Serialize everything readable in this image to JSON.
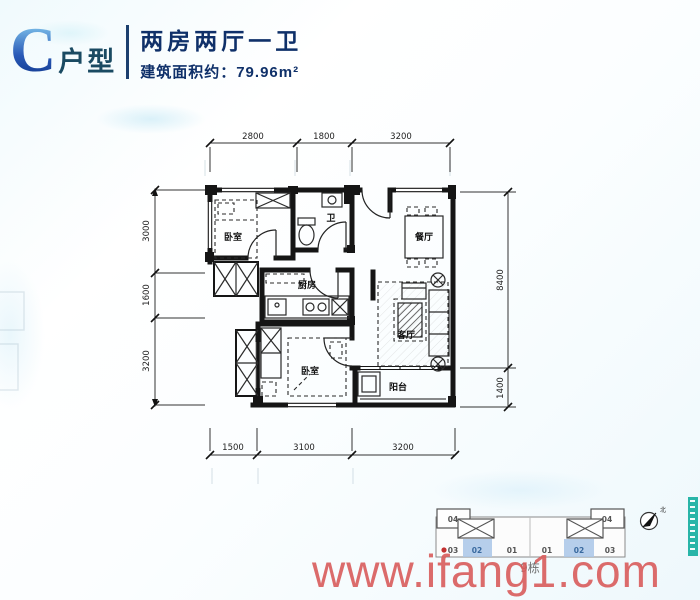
{
  "header": {
    "unit_letter": "C",
    "unit_type_suffix": "户型",
    "layout_title": "两房两厅一卫",
    "area_text": "建筑面积约：79.96m²"
  },
  "floorplan": {
    "room_labels": {
      "bedroom1": "卧室",
      "bathroom": "卫",
      "dining": "餐厅",
      "kitchen": "厨房",
      "living": "客厅",
      "bedroom2": "卧室",
      "balcony": "阳台"
    },
    "dimensions_mm": {
      "top": [
        "2800",
        "1800",
        "3200"
      ],
      "left": [
        "3000",
        "1600",
        "3200"
      ],
      "right": [
        "8400",
        "1400"
      ],
      "bottom": [
        "1500",
        "3100",
        "3200"
      ]
    }
  },
  "keyplan": {
    "building_label": "9栋",
    "corner_units": [
      "04",
      "04"
    ],
    "row_units": [
      "03",
      "02",
      "01",
      "01",
      "02",
      "03"
    ],
    "highlighted_unit": "02",
    "north_label": "北",
    "highlight_color": "#a9c5e8"
  },
  "watermark": {
    "text": "www.ifang1.com",
    "color": "#d95c5c"
  },
  "colors": {
    "header_accent": "#2a5ab8",
    "header_text": "#0f3069",
    "teal_strip": "#28b5a8"
  }
}
